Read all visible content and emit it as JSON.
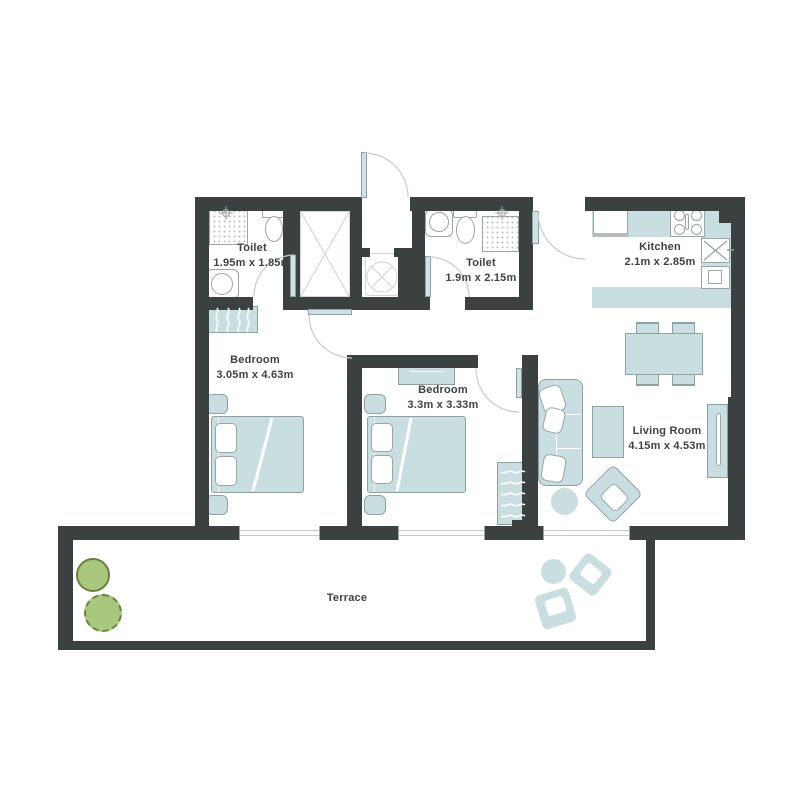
{
  "rooms": [
    {
      "id": "toilet-1",
      "name": "Toilet",
      "dims": "1.95m x 1.85m"
    },
    {
      "id": "toilet-2",
      "name": "Toilet",
      "dims": "1.9m x 2.15m"
    },
    {
      "id": "kitchen",
      "name": "Kitchen",
      "dims": "2.1m x 2.85m"
    },
    {
      "id": "bedroom-1",
      "name": "Bedroom",
      "dims": "3.05m x 4.63m"
    },
    {
      "id": "bedroom-2",
      "name": "Bedroom",
      "dims": "3.3m x 3.33m"
    },
    {
      "id": "living-room",
      "name": "Living Room",
      "dims": "4.15m x 4.53m"
    },
    {
      "id": "terrace",
      "name": "Terrace",
      "dims": ""
    }
  ],
  "colors": {
    "wall": "#3b4040",
    "furniture_fill": "#c9dee1",
    "furniture_border": "#8fa0a3",
    "door_panel": "#cfe3e6",
    "arc_line": "#c5ccce",
    "fixture_line": "#9aa5a8",
    "plant_fill": "#a9c77d",
    "plant_border": "#69803f",
    "text": "#3c4245",
    "background": "#ffffff"
  }
}
